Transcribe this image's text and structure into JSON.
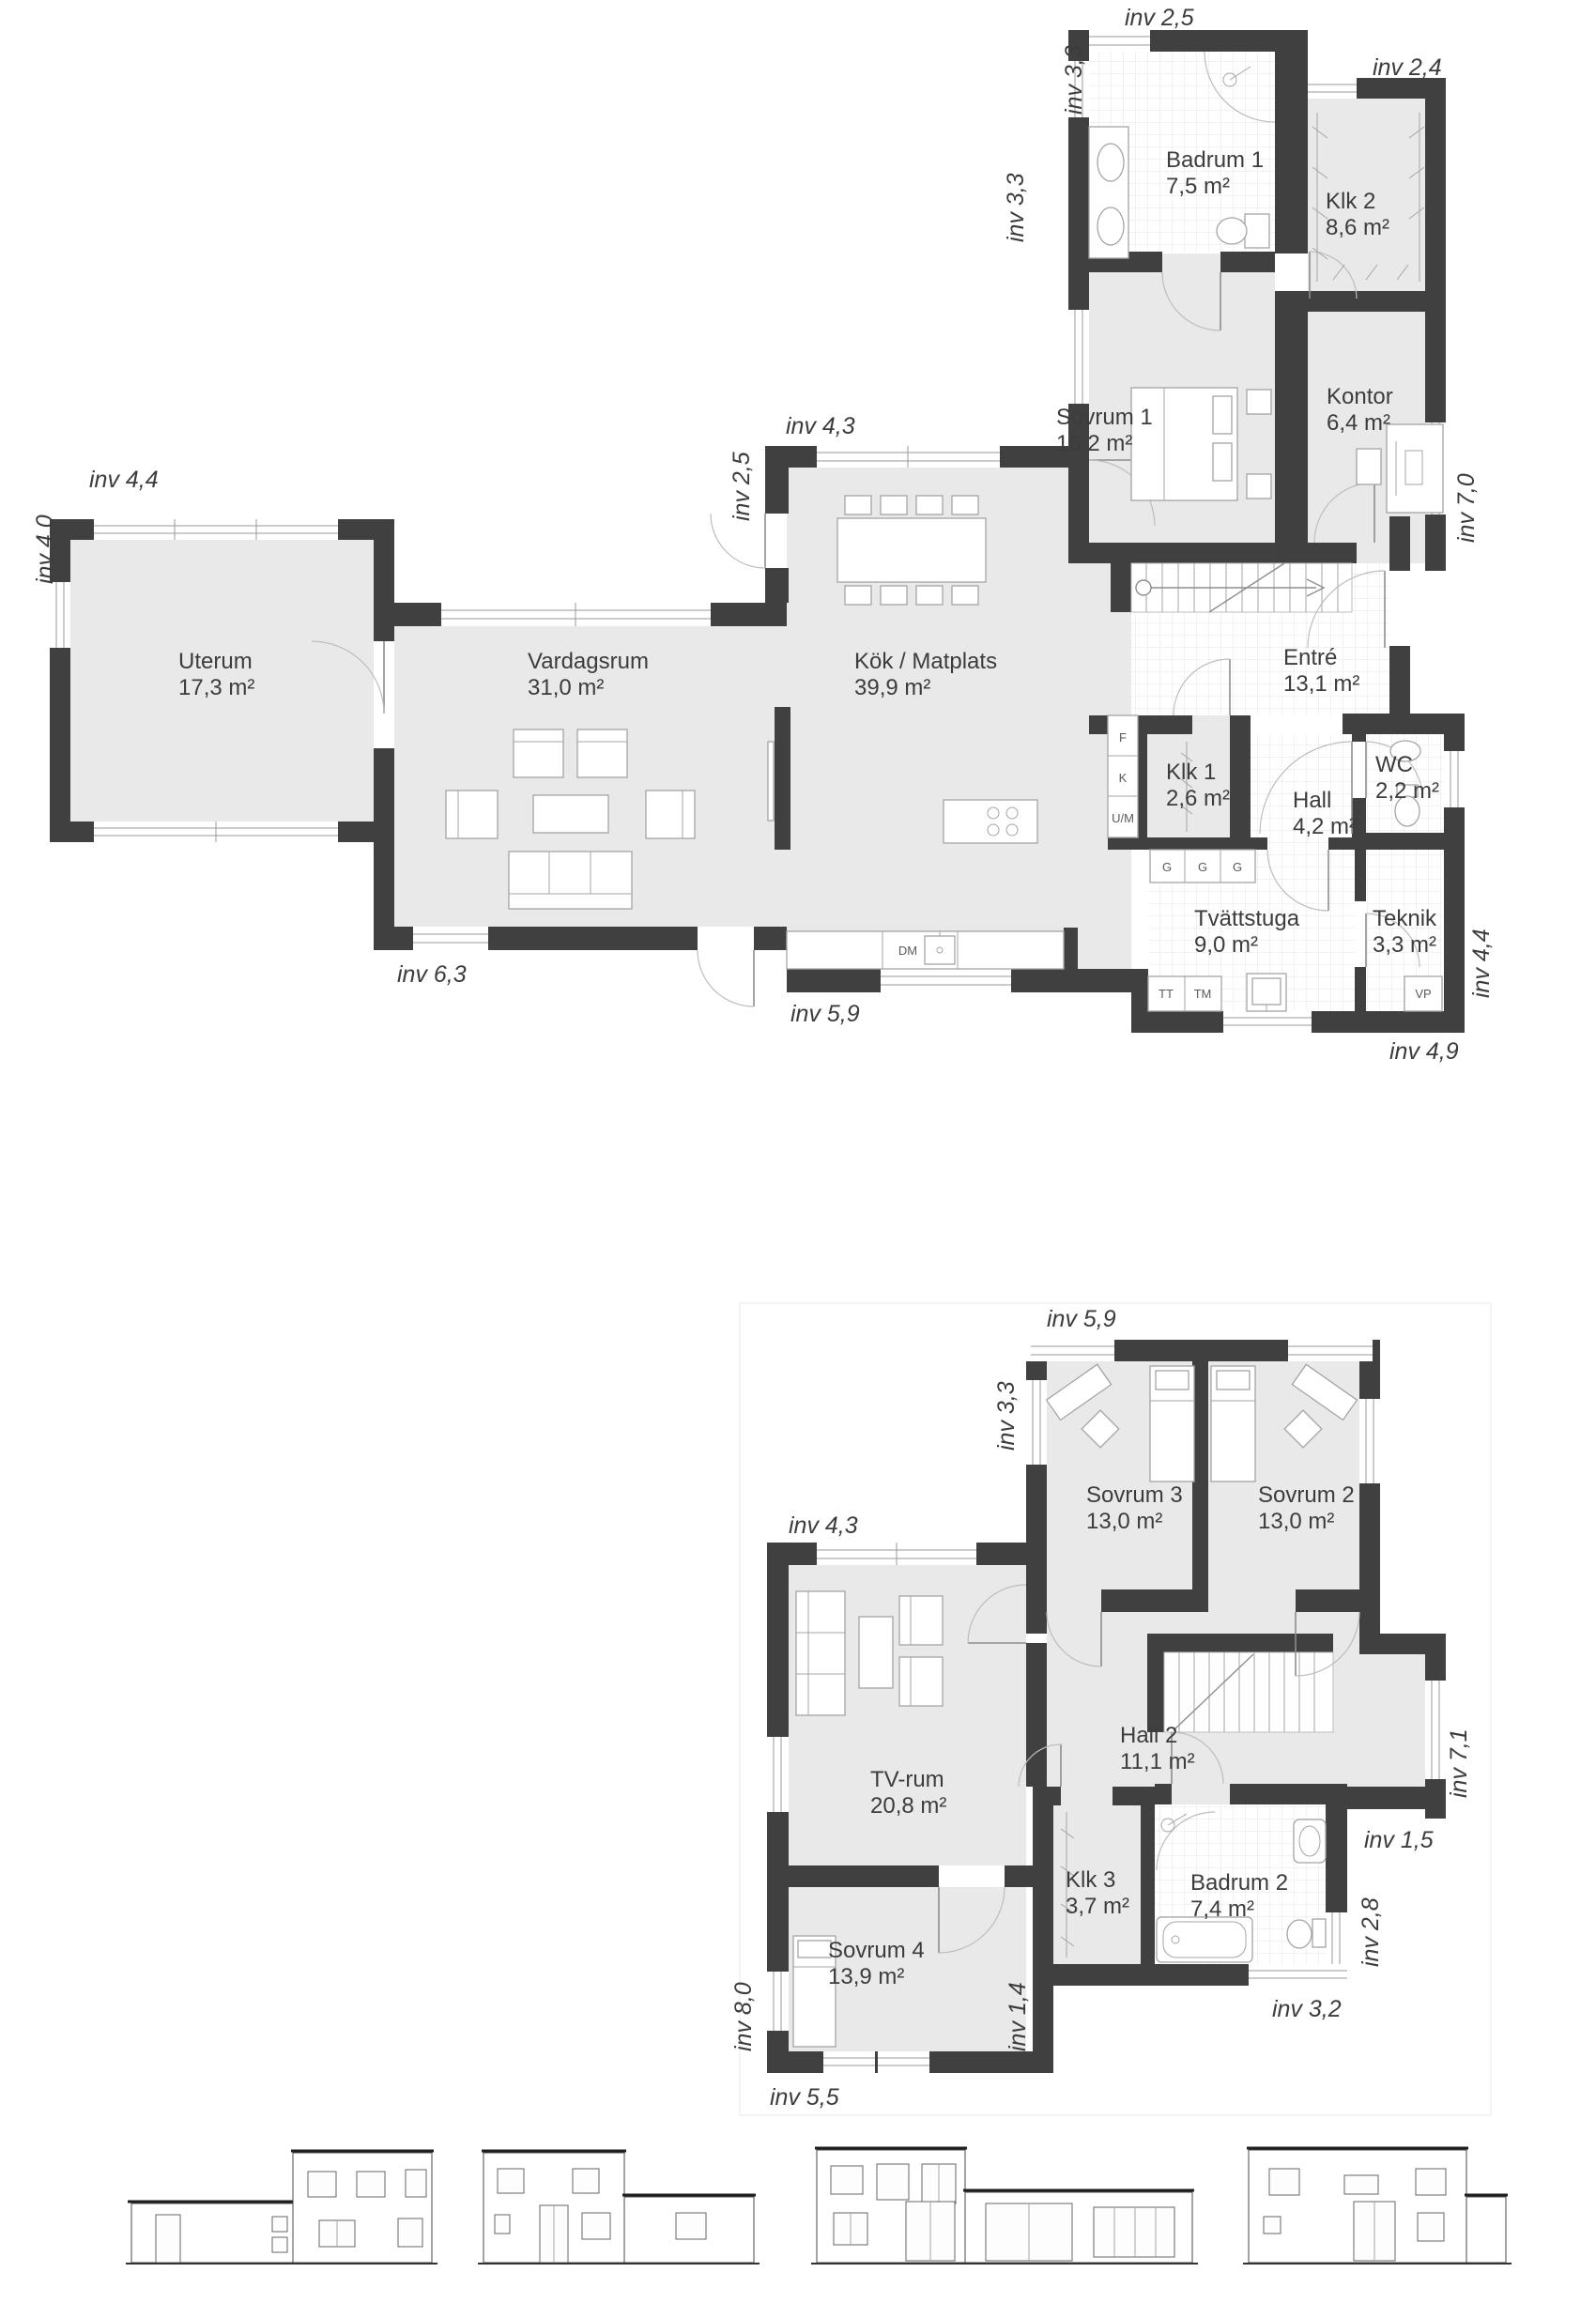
{
  "floor1": {
    "rooms": {
      "uterum": {
        "name": "Uterum",
        "area": "17,3 m²"
      },
      "vardagsrum": {
        "name": "Vardagsrum",
        "area": "31,0 m²"
      },
      "kok": {
        "name": "Kök / Matplats",
        "area": "39,9 m²"
      },
      "sovrum1": {
        "name": "Sovrum 1",
        "area": "16,2 m²"
      },
      "badrum1": {
        "name": "Badrum 1",
        "area": "7,5 m²"
      },
      "klk2": {
        "name": "Klk 2",
        "area": "8,6 m²"
      },
      "kontor": {
        "name": "Kontor",
        "area": "6,4 m²"
      },
      "entre": {
        "name": "Entré",
        "area": "13,1 m²"
      },
      "klk1": {
        "name": "Klk 1",
        "area": "2,6 m²"
      },
      "hall": {
        "name": "Hall",
        "area": "4,2 m²"
      },
      "wc": {
        "name": "WC",
        "area": "2,2 m²"
      },
      "tvattstuga": {
        "name": "Tvättstuga",
        "area": "9,0 m²"
      },
      "teknik": {
        "name": "Teknik",
        "area": "3,3 m²"
      }
    },
    "dims": {
      "top_25": "inv 2,5",
      "left_33a": "inv 3,3",
      "right_24": "inv 2,4",
      "left_33b": "inv 3,3",
      "top_43": "inv 4,3",
      "left_25": "inv 2,5",
      "top_44": "inv 4,4",
      "left_40": "inv 4,0",
      "right_70": "inv 7,0",
      "bottom_63": "inv 6,3",
      "bottom_59": "inv 5,9",
      "right_44": "inv 4,4",
      "bottom_49": "inv 4,9"
    },
    "appliances": {
      "f": "F",
      "k": "K",
      "um": "U/M",
      "g1": "G",
      "g2": "G",
      "g3": "G",
      "tt": "TT",
      "tm": "TM",
      "vp": "VP",
      "dm": "DM"
    }
  },
  "floor2": {
    "rooms": {
      "sovrum3": {
        "name": "Sovrum 3",
        "area": "13,0 m²"
      },
      "sovrum2": {
        "name": "Sovrum 2",
        "area": "13,0 m²"
      },
      "tvrum": {
        "name": "TV-rum",
        "area": "20,8 m²"
      },
      "hall2": {
        "name": "Hall 2",
        "area": "11,1 m²"
      },
      "klk3": {
        "name": "Klk 3",
        "area": "3,7 m²"
      },
      "badrum2": {
        "name": "Badrum 2",
        "area": "7,4 m²"
      },
      "sovrum4": {
        "name": "Sovrum 4",
        "area": "13,9 m²"
      }
    },
    "dims": {
      "top_59": "inv 5,9",
      "left_33": "inv 3,3",
      "top_43": "inv 4,3",
      "right_71": "inv 7,1",
      "right_15": "inv 1,5",
      "right_28": "inv 2,8",
      "left_80": "inv 8,0",
      "bottom_14": "inv 1,4",
      "bottom_32": "inv 3,2",
      "bottom_55": "inv 5,5"
    }
  }
}
